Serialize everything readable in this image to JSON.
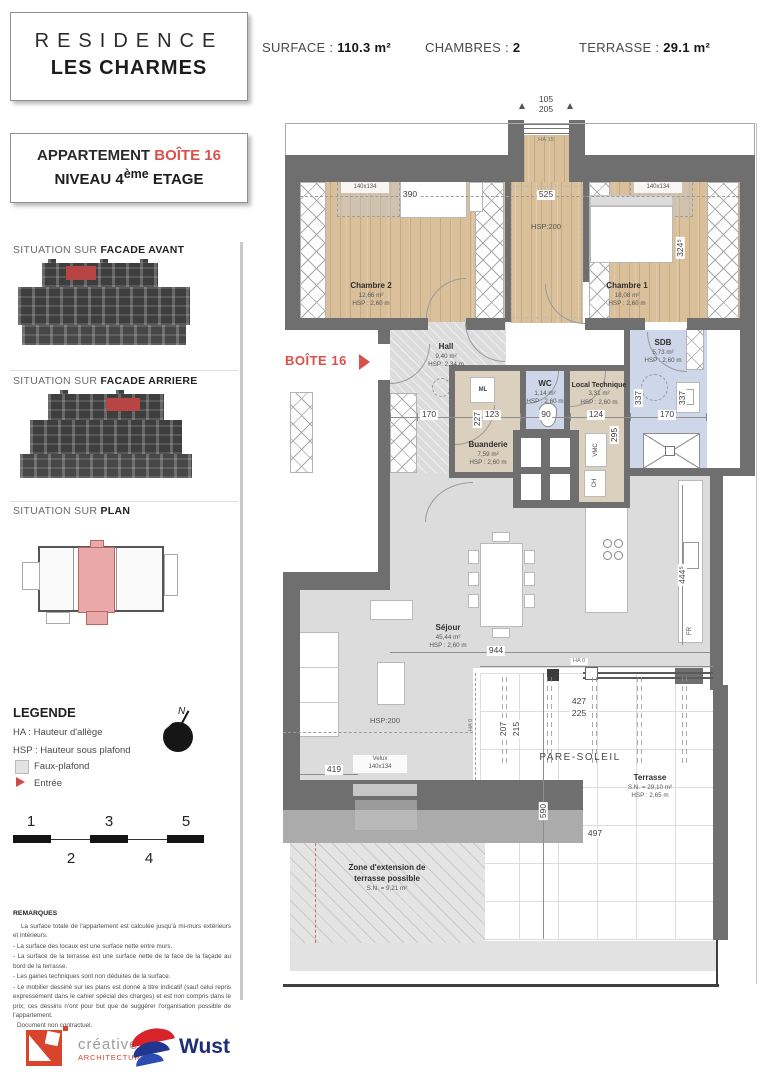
{
  "header": {
    "surface_label": "SURFACE :",
    "surface_value": "110.3 m²",
    "chambres_label": "CHAMBRES :",
    "chambres_value": "2",
    "terrasse_label": "TERRASSE :",
    "terrasse_value": "29.1 m²"
  },
  "titleblock": {
    "residence_line1": "RESIDENCE",
    "residence_line2": "LES CHARMES",
    "apartment_label": "APPARTEMENT ",
    "apartment_number": "BOÎTE 16",
    "level_prefix": "NIVEAU 4",
    "level_sup": "ème",
    "level_suffix": " ETAGE"
  },
  "sidebar": {
    "situation_prefix": "SITUATION SUR ",
    "facade_avant": "FACADE AVANT",
    "facade_arriere": "FACADE ARRIERE",
    "plan_bold": "PLAN",
    "legende": {
      "title": "LEGENDE",
      "ha": "HA : Hauteur d'allège",
      "hsp": "HSP : Hauteur sous plafond",
      "faux_plafond": "Faux-plafond",
      "entree": "Entrée",
      "north_letter": "N"
    },
    "scalebar": {
      "n1": "1",
      "n2": "2",
      "n3": "3",
      "n4": "4",
      "n5": "5"
    },
    "remarques": {
      "title": "REMARQUES",
      "lines": [
        "La surface totale de l'appartement est calculée jusqu'à mi-murs extérieurs et intérieurs.",
        "- La surface des locaux est une surface nette entre murs.",
        "- La surface de la terrasse est une surface nette de la face de la façade au bord de la terrasse.",
        "- Les gaines techniques sont non déduites de la surface.",
        "- Le mobilier dessiné sur les plans est donné à titre indicatif (sauf celui repris expressément dans le cahier spécial des charges) et est non compris dans le prix; ces dessins n'ont pour but que de suggérer l'organisation possible de l'appartement.",
        "Document non contractuel."
      ]
    }
  },
  "logos": {
    "creative_name": "créative",
    "creative_sub": "ARCHITECTURE",
    "wust": "Wust"
  },
  "plan": {
    "marker_label": "BOÎTE 16",
    "rooms": {
      "chambre2": {
        "name": "Chambre 2",
        "area": "12,66 m²",
        "hsp": "HSP : 2,60 m"
      },
      "chambre1": {
        "name": "Chambre 1",
        "area": "18,08 m²",
        "hsp": "HSP : 2,60 m"
      },
      "hall": {
        "name": "Hall",
        "area": "9,40 m²",
        "hsp": "HSP: 2,34 m"
      },
      "buanderie": {
        "name": "Buanderie",
        "area": "7,59 m²",
        "hsp": "HSP : 2,60 m"
      },
      "wc": {
        "name": "WC",
        "area": "1,14 m²",
        "hsp": "HSP : 2,60 m"
      },
      "local_technique": {
        "name": "Local Technique",
        "area": "3,31 m²",
        "hsp": "HSP : 2,60 m"
      },
      "sdb": {
        "name": "SDB",
        "area": "5,73 m²",
        "hsp": "HSP : 2,60 m"
      },
      "sejour": {
        "name": "Séjour",
        "area": "45,44 m²",
        "hsp": "HSP : 2,60 m"
      },
      "terrasse": {
        "name": "Terrasse",
        "area": "S.N. = 29,10 m²",
        "hsp": "HSP : 2,65 m"
      },
      "zone_extension": {
        "line1": "Zone d'extension de",
        "line2": "terrasse possible",
        "area": "S.N. = 9,21 m²"
      }
    },
    "equipment": {
      "ml": "ML",
      "vmc": "VMC",
      "ch": "CH",
      "fr": "FR"
    },
    "velux": {
      "label": "Velux",
      "size": "140x134"
    },
    "dimensions": {
      "d105": "105",
      "d205": "205",
      "ha15": "HA 15",
      "d390": "390",
      "d525": "525",
      "hsp200": "HSP:200",
      "d3245": "324⁵",
      "d170a": "170",
      "d227": "227",
      "d123": "123",
      "d90": "90",
      "d124": "124",
      "d295": "295",
      "d337a": "337",
      "d337b": "337",
      "d170b": "170",
      "d944": "944",
      "d4445": "444⁵",
      "d419": "419",
      "ha0": "HA 0",
      "d427": "427",
      "d225": "225",
      "d207": "207",
      "d215": "215",
      "d590": "590",
      "d497": "497",
      "pare_soleil": "PARE-SOLEIL"
    }
  }
}
